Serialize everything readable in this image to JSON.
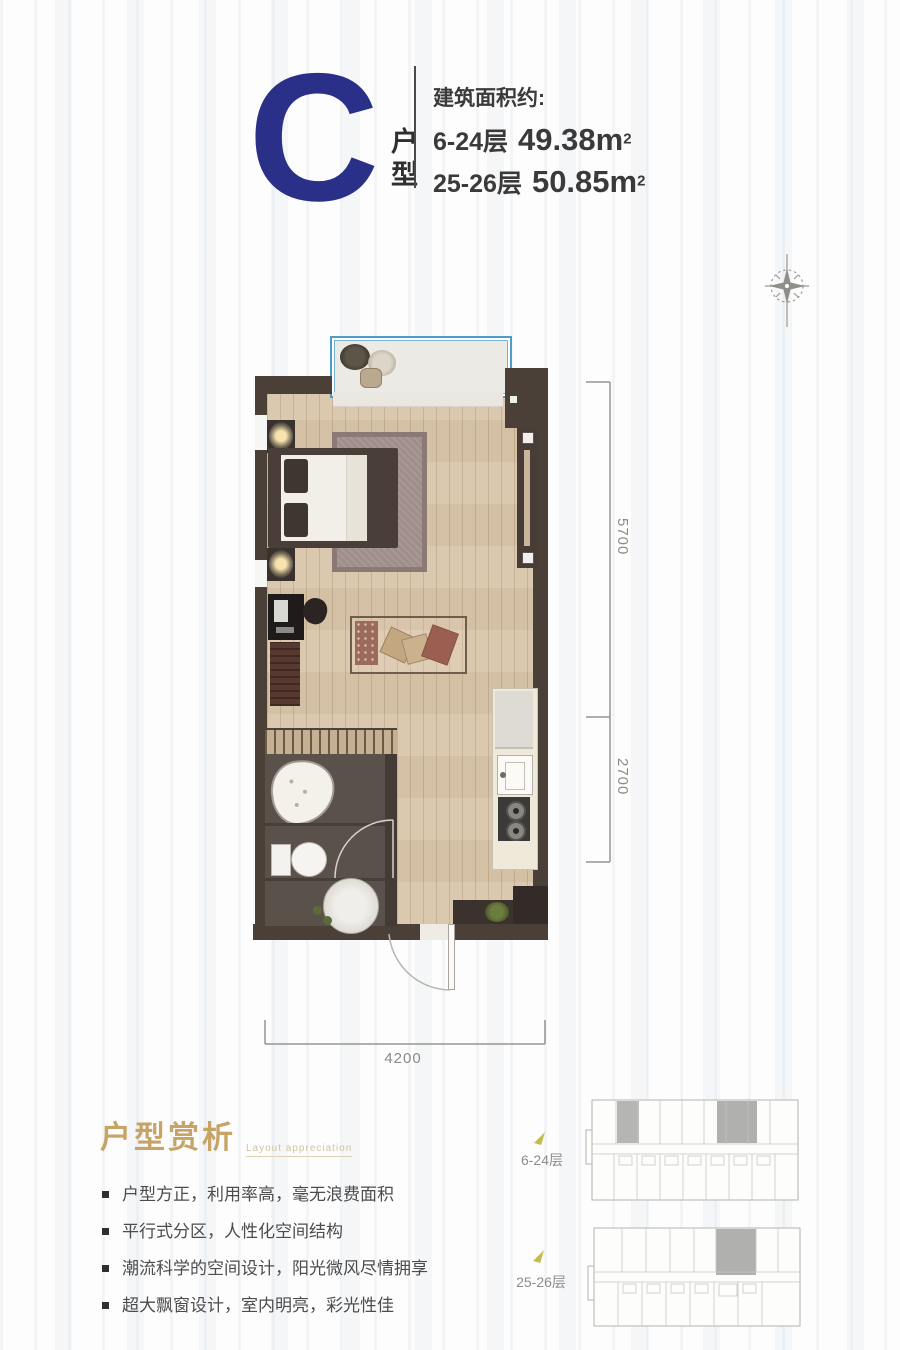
{
  "header": {
    "unit_letter": "C",
    "unit_label": "户型",
    "area_intro": "建筑面积约:",
    "area_lines": [
      {
        "floors": "6-24层",
        "value": "49.38m",
        "sup": "2"
      },
      {
        "floors": "25-26层",
        "value": "50.85m",
        "sup": "2"
      }
    ]
  },
  "plan": {
    "dims": {
      "right_upper": "5700",
      "right_lower": "2700",
      "bottom": "4200"
    }
  },
  "analysis": {
    "title": "户型赏析",
    "subtitle": "Layout appreciation",
    "bullets": [
      "户型方正，利用率高，毫无浪费面积",
      "平行式分区，人性化空间结构",
      "潮流科学的空间设计，阳光微风尽情拥享",
      "超大飘窗设计，室内明亮，彩光性佳"
    ]
  },
  "floor_plates": [
    {
      "label": "6-24层"
    },
    {
      "label": "25-26层"
    }
  ],
  "colors": {
    "navy": "#2a3088",
    "gold_heading": "#c6a468",
    "wall": "#4b4037",
    "wood_floor": "#d9c6aa",
    "window_blue": "#4f9cc6",
    "dimension_gray": "#8b8a85",
    "plate_highlight": "#b3b3b1"
  }
}
